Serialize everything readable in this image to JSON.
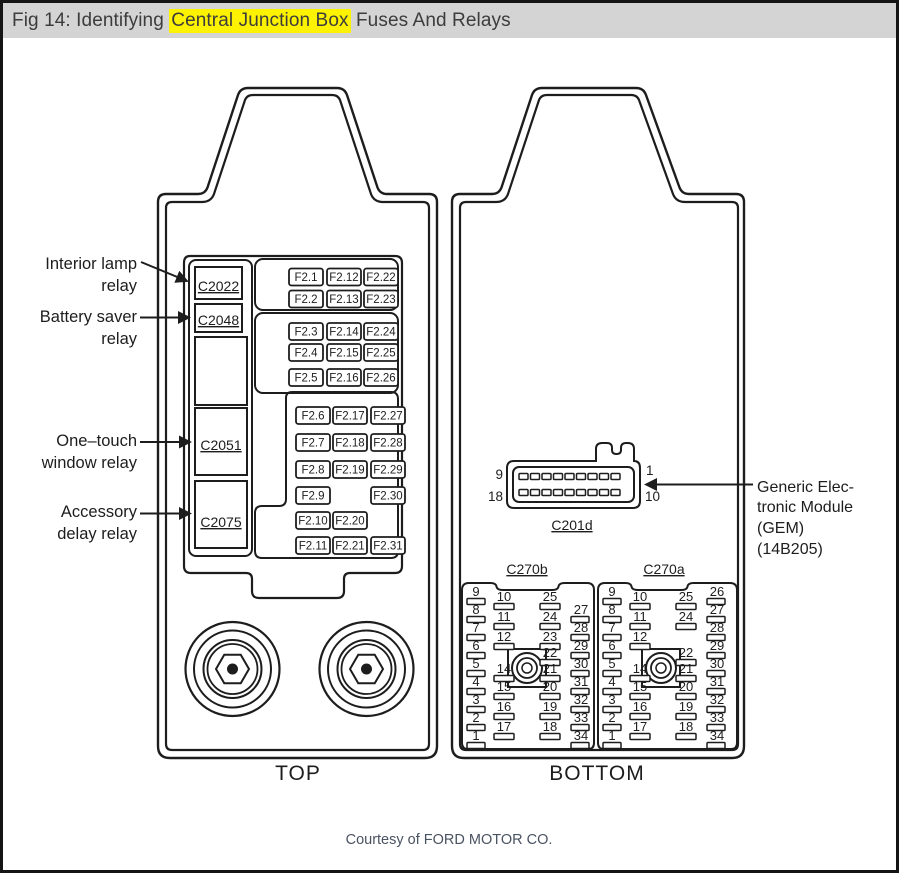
{
  "title": {
    "prefix": "Fig 14: Identifying ",
    "highlight": "Central Junction Box",
    "suffix": " Fuses And Relays"
  },
  "colors": {
    "title_bar_bg": "#d4d4d4",
    "highlight_bg": "#fdf300",
    "ink": "#1d1d1d",
    "title_text": "#3c3c3c",
    "courtesy_text": "#4a5362"
  },
  "top_view": {
    "caption": "TOP",
    "relay_labels": [
      {
        "lines": [
          "Interior lamp",
          "relay"
        ]
      },
      {
        "lines": [
          "Battery saver",
          "relay"
        ]
      },
      {
        "lines": [
          "One–touch",
          "window relay"
        ]
      },
      {
        "lines": [
          "Accessory",
          "delay relay"
        ]
      }
    ],
    "relay_connectors": [
      "C2022",
      "C2048",
      "C2051",
      "C2075"
    ],
    "fuse_groups": [
      {
        "rows": [
          [
            "F2.1",
            "F2.12",
            "F2.22"
          ],
          [
            "F2.2",
            "F2.13",
            "F2.23"
          ]
        ]
      },
      {
        "rows": [
          [
            "F2.3",
            "F2.14",
            "F2.24"
          ],
          [
            "F2.4",
            "F2.15",
            "F2.25"
          ],
          [
            "F2.5",
            "F2.16",
            "F2.26"
          ]
        ]
      },
      {
        "rows": [
          [
            "F2.6",
            "F2.17",
            "F2.27"
          ],
          [
            "F2.7",
            "F2.18",
            "F2.28"
          ],
          [
            "F2.8",
            "F2.19",
            "F2.29"
          ],
          [
            "F2.9",
            null,
            "F2.30"
          ],
          [
            "F2.10",
            "F2.20",
            null
          ],
          [
            "F2.11",
            "F2.21",
            "F2.31"
          ]
        ]
      }
    ]
  },
  "bottom_view": {
    "caption": "BOTTOM",
    "gem_label": {
      "lines": [
        "Generic Elec-",
        "tronic Module",
        "(GEM)",
        "(14B205)"
      ]
    },
    "c201d": {
      "name": "C201d",
      "top_left": "9",
      "top_right": "1",
      "bottom_left": "18",
      "bottom_right": "10"
    },
    "connectors": [
      {
        "name": "C270b",
        "left_pins": [
          "9",
          "8",
          "7",
          "6",
          "5",
          "4",
          "3",
          "2",
          "1"
        ],
        "col2_pins": [
          "10",
          "11",
          "12",
          null,
          "14",
          "15",
          "16",
          "17"
        ],
        "col3_pins": [
          "25",
          "24",
          "23",
          "22",
          "21",
          "20",
          "19",
          "18"
        ],
        "right_pins": [
          "27",
          "28",
          "29",
          "30",
          "31",
          "32",
          "33",
          "34"
        ]
      },
      {
        "name": "C270a",
        "left_pins": [
          "9",
          "8",
          "7",
          "6",
          "5",
          "4",
          "3",
          "2",
          "1"
        ],
        "col2_pins": [
          "10",
          "11",
          "12",
          null,
          "14",
          "15",
          "16",
          "17"
        ],
        "col3_pins": [
          "25",
          "24",
          null,
          "22",
          "21",
          "20",
          "19",
          "18"
        ],
        "right_pins": [
          "26",
          "27",
          "28",
          "29",
          "30",
          "31",
          "32",
          "33",
          "34"
        ]
      }
    ]
  },
  "footer": {
    "courtesy": "Courtesy of FORD MOTOR CO."
  }
}
